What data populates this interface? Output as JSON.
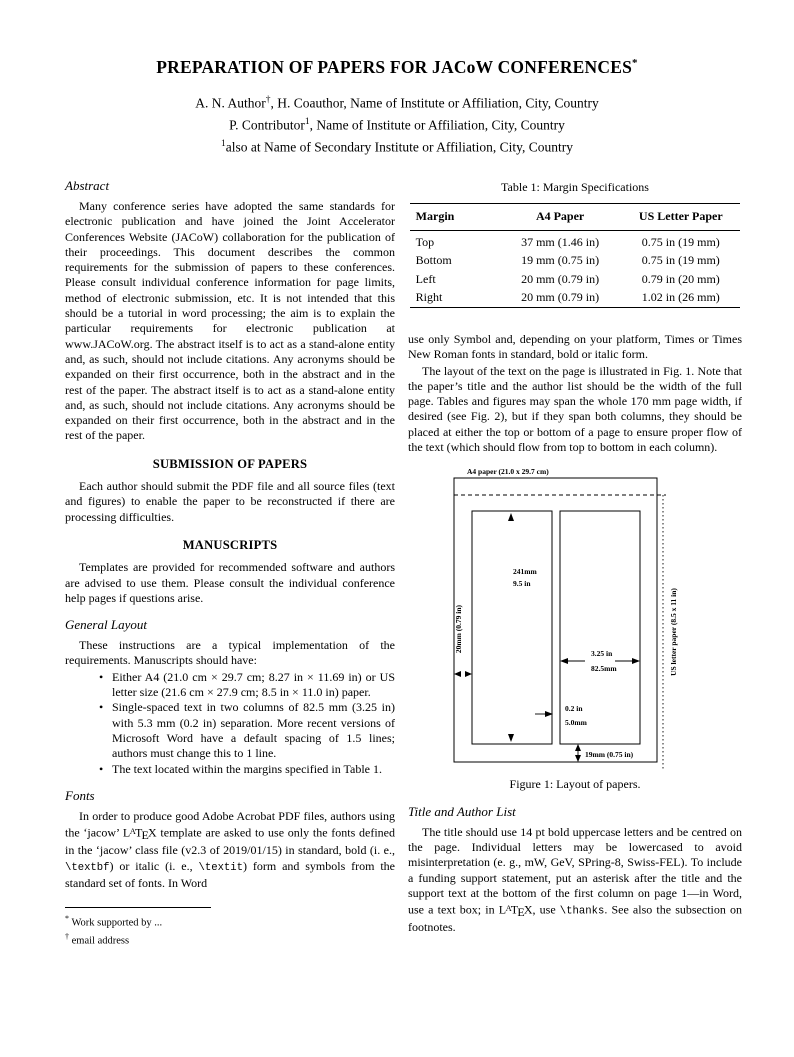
{
  "page": {
    "title": "PREPARATION OF PAPERS FOR JACoW CONFERENCES",
    "title_sup": "*",
    "authors": [
      {
        "pre": "A. N. Author",
        "sup": "†",
        "post": ", H. Coauthor, Name of Institute or Affiliation, City, Country"
      },
      {
        "pre": "P. Contributor",
        "sup": "1",
        "post": ", Name of Institute or Affiliation, City, Country"
      },
      {
        "pre": "",
        "sup": "1",
        "post": "also at Name of Secondary Institute or Affiliation, City, Country"
      }
    ]
  },
  "left": {
    "abstract_heading": "Abstract",
    "abstract_text": "Many conference series have adopted the same standards for electronic publication and have joined the Joint Accelerator Conferences Website (JACoW) collaboration for the publication of their proceedings. This document describes the common requirements for the submission of papers to these conferences. Please consult individual conference information for page limits, method of electronic submission, etc. It is not intended that this should be a tutorial in word processing; the aim is to explain the particular requirements for electronic publication at www.JACoW.org. The abstract itself is to act as a stand-alone entity and, as such, should not include citations. Any acronyms should be expanded on their first occurrence, both in the abstract and in the rest of the paper. The abstract itself is to act as a stand-alone entity and, as such, should not include citations. Any acronyms should be expanded on their first occurrence, both in the abstract and in the rest of the paper.",
    "submission_heading": "SUBMISSION OF PAPERS",
    "submission_text": "Each author should submit the PDF file and all source files (text and figures) to enable the paper to be reconstructed if there are processing difficulties.",
    "manuscripts_heading": "MANUSCRIPTS",
    "manuscripts_text": "Templates are provided for recommended software and authors are advised to use them. Please consult the individual conference help pages if questions arise.",
    "general_layout_heading": "General Layout",
    "general_layout_intro": "These instructions are a typical implementation of the requirements. Manuscripts should have:",
    "bullets": [
      "Either A4 (21.0 cm × 29.7 cm; 8.27 in × 11.69 in) or US letter size (21.6 cm × 27.9 cm; 8.5 in × 11.0 in) paper.",
      "Single-spaced text in two columns of 82.5 mm (3.25 in) with 5.3 mm (0.2 in) separation. More recent versions of Microsoft Word have a default spacing of 1.5 lines; authors must change this to 1 line.",
      "The text located within the margins specified in Table 1."
    ],
    "fonts_heading": "Fonts",
    "fonts_segments": [
      {
        "t": "In order to produce good Adobe Acrobat PDF files, authors using the ‘jacow’ "
      },
      {
        "t": "L"
      },
      {
        "t": "A",
        "s": "latex-a"
      },
      {
        "t": "T"
      },
      {
        "t": "E",
        "s": "latex-e"
      },
      {
        "t": "X"
      },
      {
        "t": " template are asked to use only the fonts defined in the ‘jacow’ class file (v2.3 of 2019/01/15) in standard, bold (i. e., "
      },
      {
        "t": "\\textbf",
        "s": "mono"
      },
      {
        "t": ") or italic (i. e., "
      },
      {
        "t": "\\textit",
        "s": "mono"
      },
      {
        "t": ") form and symbols from the standard set of fonts. In Word"
      }
    ],
    "footnotes": [
      {
        "sup": "*",
        "text": "Work supported by ..."
      },
      {
        "sup": "†",
        "text": "email address"
      }
    ]
  },
  "right": {
    "table": {
      "caption": "Table 1: Margin Specifications",
      "headers": [
        "Margin",
        "A4 Paper",
        "US Letter Paper"
      ],
      "rows": [
        [
          "Top",
          "37 mm (1.46 in)",
          "0.75 in (19 mm)"
        ],
        [
          "Bottom",
          "19 mm (0.75 in)",
          "0.75 in (19 mm)"
        ],
        [
          "Left",
          "20 mm (0.79 in)",
          "0.79 in (20 mm)"
        ],
        [
          "Right",
          "20 mm (0.79 in)",
          "1.02 in (26 mm)"
        ]
      ]
    },
    "para1": "use only Symbol and, depending on your platform, Times or Times New Roman fonts in standard, bold or italic form.",
    "para2": "The layout of the text on the page is illustrated in Fig. 1. Note that the paper’s title and the author list should be the width of the full page. Tables and figures may span the whole 170 mm page width, if desired (see Fig. 2), but if they span both columns, they should be placed at either the top or bottom of a page to ensure proper flow of the text (which should flow from top to bottom in each column).",
    "figure": {
      "a4_label": "A4 paper (21.0 x 29.7 cm)",
      "col_height_1": "241mm",
      "col_height_2": "9.5 in",
      "left_margin": "20mm (0.79 in)",
      "col_width_1": "3.25 in",
      "col_width_2": "82.5mm",
      "gap_1": "0.2 in",
      "gap_2": "5.0mm",
      "bottom_margin": "19mm (0.75 in)",
      "us_letter": "US letter paper (8.5 x 11 in)",
      "caption": "Figure 1: Layout of papers."
    },
    "title_author_heading": "Title and Author List",
    "title_author_segments": [
      {
        "t": "The title should use 14 pt bold uppercase letters and be centred on the page. Individual letters may be lowercased to avoid misinterpretation (e. g., mW, GeV, SPring-8, Swiss-FEL). To include a funding support statement, put an asterisk after the title and the support text at the bottom of the first column on page 1—in Word, use a text box; in "
      },
      {
        "t": "L"
      },
      {
        "t": "A",
        "s": "latex-a"
      },
      {
        "t": "T"
      },
      {
        "t": "E",
        "s": "latex-e"
      },
      {
        "t": "X"
      },
      {
        "t": ", use "
      },
      {
        "t": "\\thanks",
        "s": "mono"
      },
      {
        "t": ". See also the subsection on footnotes."
      }
    ]
  }
}
